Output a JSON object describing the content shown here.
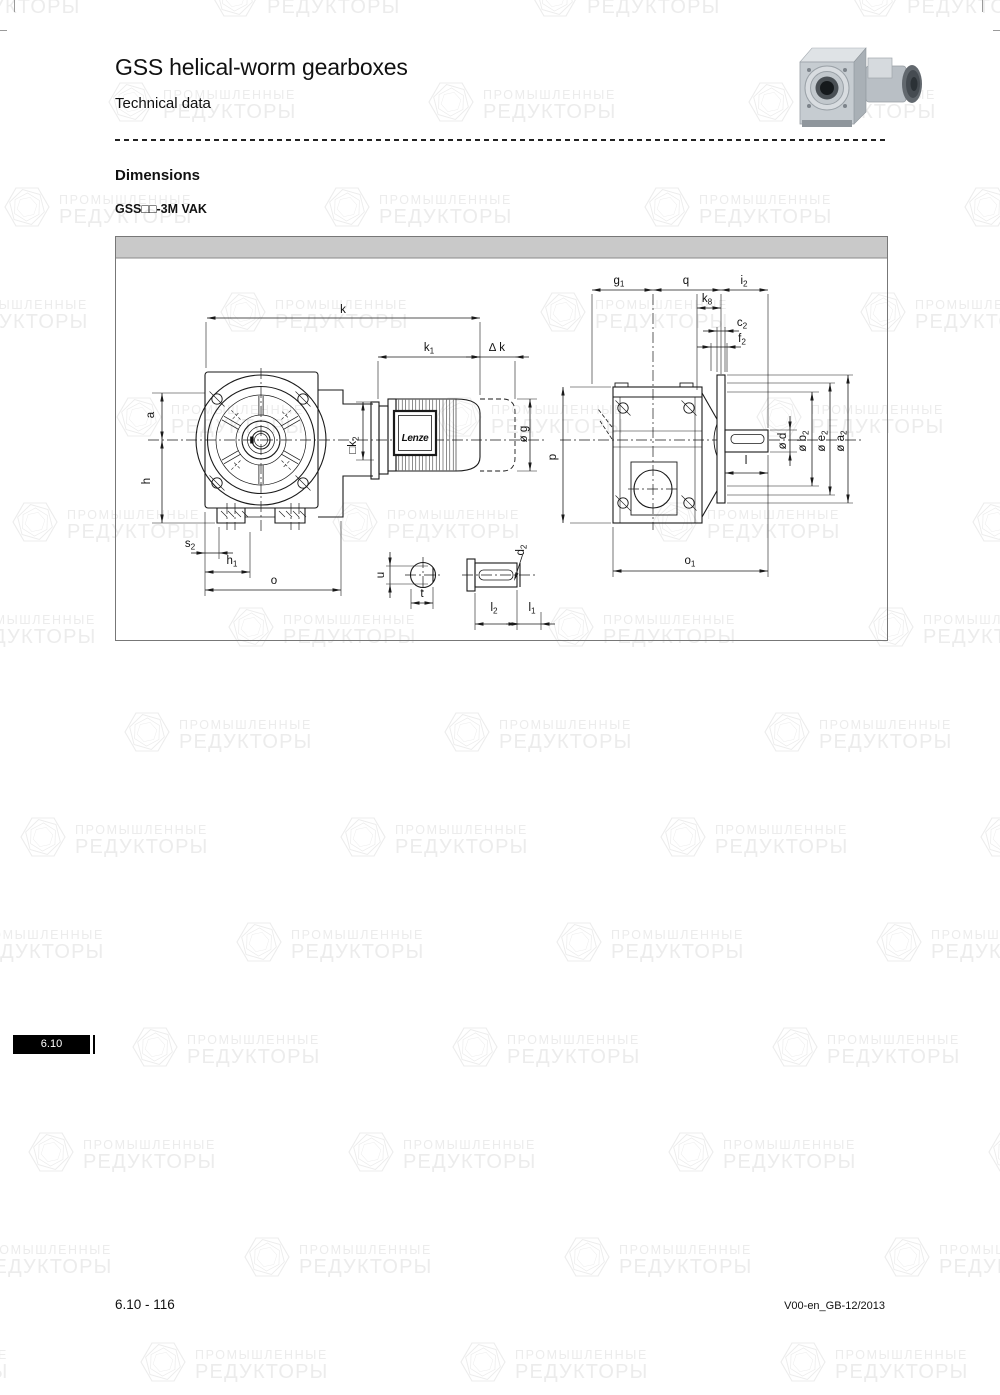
{
  "page": {
    "title": "GSS helical-worm gearboxes",
    "subtitle": "Technical data",
    "section_heading": "Dimensions",
    "variant_label": "GSS□□-3M VAK",
    "tab_label": "6.10",
    "footer_left": "6.10 - 116",
    "footer_right": "V00-en_GB-12/2013"
  },
  "watermark": {
    "line1": "ПРОМЫШЛЕННЫЕ",
    "line2": "РЕДУКТОРЫ",
    "color": "#ececec"
  },
  "drawing": {
    "motor_brand": "Lenze",
    "frame_header_color": "#c9c9c9",
    "labels": [
      {
        "id": "k",
        "text": "k",
        "sub": "",
        "x": 343,
        "y": 313,
        "rot": 0
      },
      {
        "id": "k1",
        "text": "k",
        "sub": "1",
        "x": 429,
        "y": 351,
        "rot": 0
      },
      {
        "id": "delta-k",
        "text": "∆ k",
        "sub": "",
        "x": 497,
        "y": 351,
        "rot": 0
      },
      {
        "id": "k2",
        "text": "□k",
        "sub": "2",
        "x": 356,
        "y": 445,
        "rot": -90
      },
      {
        "id": "g",
        "text": "ø g",
        "sub": "",
        "x": 527,
        "y": 434,
        "rot": -90
      },
      {
        "id": "a",
        "text": "a",
        "sub": "",
        "x": 154,
        "y": 415,
        "rot": -90
      },
      {
        "id": "h",
        "text": "h",
        "sub": "",
        "x": 150,
        "y": 481,
        "rot": -90
      },
      {
        "id": "s2",
        "text": "s",
        "sub": "2",
        "x": 190,
        "y": 547,
        "rot": 0
      },
      {
        "id": "h1",
        "text": "h",
        "sub": "1",
        "x": 232,
        "y": 564,
        "rot": 0
      },
      {
        "id": "o",
        "text": "o",
        "sub": "",
        "x": 274,
        "y": 584,
        "rot": 0
      },
      {
        "id": "u",
        "text": "u",
        "sub": "",
        "x": 384,
        "y": 575,
        "rot": -90
      },
      {
        "id": "t",
        "text": "t",
        "sub": "",
        "x": 422,
        "y": 597,
        "rot": 0
      },
      {
        "id": "d2",
        "text": "d",
        "sub": "2",
        "x": 524,
        "y": 550,
        "rot": -90
      },
      {
        "id": "l2",
        "text": "l",
        "sub": "2",
        "x": 494,
        "y": 611,
        "rot": 0
      },
      {
        "id": "l1",
        "text": "l",
        "sub": "1",
        "x": 532,
        "y": 611,
        "rot": 0
      },
      {
        "id": "g1",
        "text": "g",
        "sub": "1",
        "x": 619,
        "y": 284,
        "rot": 0
      },
      {
        "id": "q",
        "text": "q",
        "sub": "",
        "x": 686,
        "y": 284,
        "rot": 0
      },
      {
        "id": "i2",
        "text": "i",
        "sub": "2",
        "x": 744,
        "y": 284,
        "rot": 0
      },
      {
        "id": "k8",
        "text": "k",
        "sub": "8",
        "x": 707,
        "y": 302,
        "rot": 0
      },
      {
        "id": "c2",
        "text": "c",
        "sub": "2",
        "x": 742,
        "y": 326,
        "rot": 0
      },
      {
        "id": "f2",
        "text": "f",
        "sub": "2",
        "x": 742,
        "y": 342,
        "rot": 0
      },
      {
        "id": "p",
        "text": "p",
        "sub": "",
        "x": 556,
        "y": 457,
        "rot": -90
      },
      {
        "id": "d",
        "text": "ø d",
        "sub": "",
        "x": 786,
        "y": 441,
        "rot": -90
      },
      {
        "id": "b2",
        "text": "ø b",
        "sub": "2",
        "x": 806,
        "y": 441,
        "rot": -90
      },
      {
        "id": "e2",
        "text": "ø e",
        "sub": "2",
        "x": 825,
        "y": 441,
        "rot": -90
      },
      {
        "id": "a2",
        "text": "ø a",
        "sub": "2",
        "x": 844,
        "y": 441,
        "rot": -90
      },
      {
        "id": "l",
        "text": "l",
        "sub": "",
        "x": 746,
        "y": 464,
        "rot": 0
      },
      {
        "id": "o1",
        "text": "o",
        "sub": "1",
        "x": 690,
        "y": 564,
        "rot": 0
      }
    ]
  }
}
